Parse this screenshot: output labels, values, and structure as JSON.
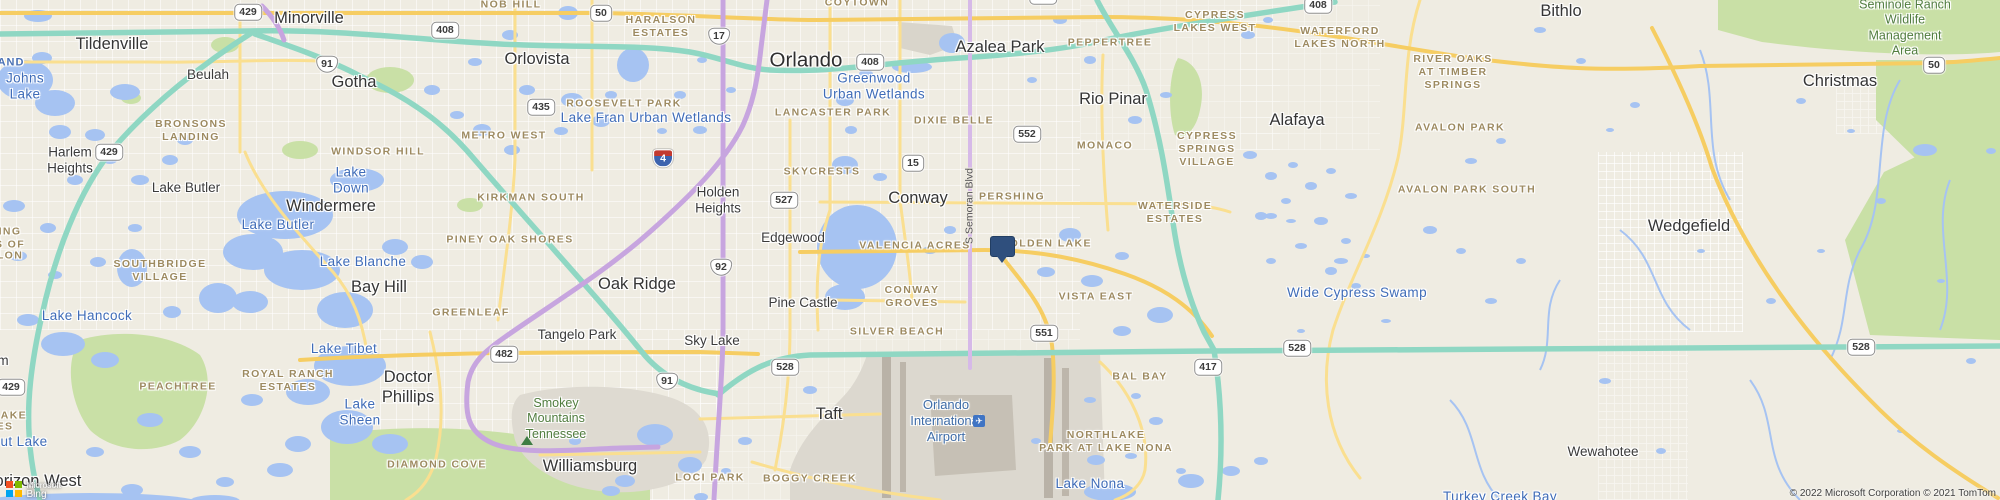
{
  "map": {
    "colors": {
      "land": "#efece2",
      "urban": "#e8e5dc",
      "water": "#a6c3f2",
      "park_green": "#c9e0a6",
      "toll_teal": "#8fd7c3",
      "interstate_purple": "#c7a5df",
      "arterial_yellow": "#f6cd62",
      "marker_navy": "#2f4f7d",
      "water_label_blue": "#3f6cb8",
      "hood_label_brown": "#9d8a60"
    },
    "marker": {
      "x": 1001,
      "y": 247,
      "shape": "pushpin"
    },
    "labels": [
      {
        "t": "Orlando",
        "x": 806,
        "y": 60,
        "c": "city-xl",
        "n": "label-city-orlando"
      },
      {
        "t": "Tildenville",
        "x": 112,
        "y": 44,
        "c": "city-lg",
        "n": "label-city-tildenville"
      },
      {
        "t": "Minorville",
        "x": 309,
        "y": 18,
        "c": "city-lg",
        "n": "label-city-minorville"
      },
      {
        "t": "Beulah",
        "x": 208,
        "y": 75,
        "c": "city",
        "n": "label-city-beulah"
      },
      {
        "t": "Gotha",
        "x": 354,
        "y": 82,
        "c": "city-lg",
        "n": "label-city-gotha"
      },
      {
        "t": "Orlovista",
        "x": 537,
        "y": 59,
        "c": "city-lg",
        "n": "label-city-orlovista"
      },
      {
        "t": "Azalea Park",
        "x": 1000,
        "y": 47,
        "c": "city-lg",
        "n": "label-city-azalea-park"
      },
      {
        "t": "Bithlo",
        "x": 1561,
        "y": 11,
        "c": "city-lg",
        "n": "label-city-bithlo"
      },
      {
        "t": "Christmas",
        "x": 1840,
        "y": 81,
        "c": "city-lg",
        "n": "label-city-christmas"
      },
      {
        "t": "Harlem\nHeights",
        "x": 70,
        "y": 161,
        "c": "city",
        "n": "label-city-harlem-heights"
      },
      {
        "t": "Lake Butler",
        "x": 186,
        "y": 188,
        "c": "city",
        "n": "label-city-lake-butler"
      },
      {
        "t": "Windermere",
        "x": 331,
        "y": 206,
        "c": "city-lg",
        "n": "label-city-windermere"
      },
      {
        "t": "Bay Hill",
        "x": 379,
        "y": 287,
        "c": "city-lg",
        "n": "label-city-bay-hill"
      },
      {
        "t": "Doctor\nPhillips",
        "x": 408,
        "y": 387,
        "c": "city-lg",
        "n": "label-city-doctor-phillips"
      },
      {
        "t": "Oak Ridge",
        "x": 637,
        "y": 284,
        "c": "city-lg",
        "n": "label-city-oak-ridge"
      },
      {
        "t": "Holden\nHeights",
        "x": 718,
        "y": 201,
        "c": "city",
        "n": "label-city-holden-heights"
      },
      {
        "t": "Edgewood",
        "x": 793,
        "y": 238,
        "c": "city",
        "n": "label-city-edgewood"
      },
      {
        "t": "Conway",
        "x": 918,
        "y": 198,
        "c": "city-lg",
        "n": "label-city-conway"
      },
      {
        "t": "Pine Castle",
        "x": 803,
        "y": 303,
        "c": "city",
        "n": "label-city-pine-castle"
      },
      {
        "t": "Rio Pinar",
        "x": 1113,
        "y": 99,
        "c": "city-lg",
        "n": "label-city-rio-pinar"
      },
      {
        "t": "Alafaya",
        "x": 1297,
        "y": 120,
        "c": "city-lg",
        "n": "label-city-alafaya"
      },
      {
        "t": "Wedgefield",
        "x": 1689,
        "y": 226,
        "c": "city-lg",
        "n": "label-city-wedgefield"
      },
      {
        "t": "Taft",
        "x": 829,
        "y": 414,
        "c": "city-lg",
        "n": "label-city-taft"
      },
      {
        "t": "Williamsburg",
        "x": 590,
        "y": 466,
        "c": "city-lg",
        "n": "label-city-williamsburg"
      },
      {
        "t": "Sky Lake",
        "x": 712,
        "y": 341,
        "c": "city",
        "n": "label-city-sky-lake"
      },
      {
        "t": "Tangelo Park",
        "x": 577,
        "y": 335,
        "c": "city",
        "n": "label-city-tangelo-park"
      },
      {
        "t": "Horizon West",
        "x": 32,
        "y": 481,
        "c": "city-lg",
        "n": "label-city-horizon-west"
      },
      {
        "t": "Wewahotee",
        "x": 1603,
        "y": 452,
        "c": "city",
        "n": "label-city-wewahotee"
      },
      {
        "t": "m",
        "x": 3,
        "y": 361,
        "c": "city",
        "n": "label-fragment"
      },
      {
        "t": "Johns\nLake",
        "x": 25,
        "y": 87,
        "c": "water",
        "n": "label-water-johns-lake"
      },
      {
        "t": "Lake\nDown",
        "x": 351,
        "y": 181,
        "c": "water",
        "n": "label-water-lake-down"
      },
      {
        "t": "Lake Butler",
        "x": 278,
        "y": 225,
        "c": "water",
        "n": "label-water-lake-butler"
      },
      {
        "t": "Lake Blanche",
        "x": 363,
        "y": 262,
        "c": "water",
        "n": "label-water-lake-blanche"
      },
      {
        "t": "Lake Tibet",
        "x": 344,
        "y": 349,
        "c": "water",
        "n": "label-water-lake-tibet"
      },
      {
        "t": "Lake\nSheen",
        "x": 360,
        "y": 413,
        "c": "water",
        "n": "label-water-lake-sheen"
      },
      {
        "t": "Lake Hancock",
        "x": 87,
        "y": 316,
        "c": "water",
        "n": "label-water-lake-hancock"
      },
      {
        "t": "ut Lake",
        "x": 24,
        "y": 442,
        "c": "water",
        "n": "label-water-fragment"
      },
      {
        "t": "AND",
        "x": 11,
        "y": 63,
        "c": "water-frag",
        "n": "label-water-fragment"
      },
      {
        "t": "Lake Fran Urban Wetlands",
        "x": 646,
        "y": 118,
        "c": "water",
        "n": "label-water-lake-fran"
      },
      {
        "t": "Greenwood\nUrban Wetlands",
        "x": 874,
        "y": 87,
        "c": "water",
        "n": "label-water-greenwood"
      },
      {
        "t": "Wide Cypress Swamp",
        "x": 1357,
        "y": 293,
        "c": "water",
        "n": "label-water-wide-cypress-swamp"
      },
      {
        "t": "Lake Nona",
        "x": 1090,
        "y": 484,
        "c": "water",
        "n": "label-water-lake-nona"
      },
      {
        "t": "Turkey Creek Bay",
        "x": 1500,
        "y": 497,
        "c": "water",
        "n": "label-water-turkey-creek-bay"
      },
      {
        "t": "NOB HILL",
        "x": 511,
        "y": 5,
        "c": "hood",
        "n": "label-hood-nob-hill"
      },
      {
        "t": "COYTOWN",
        "x": 857,
        "y": 3,
        "c": "hood",
        "n": "label-hood-coytown"
      },
      {
        "t": "HARALSON\nESTATES",
        "x": 661,
        "y": 27,
        "c": "hood",
        "n": "label-hood-haralson-estates"
      },
      {
        "t": "CYPRESS\nLAKES WEST",
        "x": 1215,
        "y": 22,
        "c": "hood",
        "n": "label-hood-cypress-lakes-west"
      },
      {
        "t": "WATERFORD\nLAKES NORTH",
        "x": 1340,
        "y": 38,
        "c": "hood",
        "n": "label-hood-waterford-lakes-north"
      },
      {
        "t": "RIVER OAKS\nAT TIMBER\nSPRINGS",
        "x": 1453,
        "y": 72,
        "c": "hood",
        "n": "label-hood-river-oaks"
      },
      {
        "t": "AVALON PARK",
        "x": 1460,
        "y": 128,
        "c": "hood",
        "n": "label-hood-avalon-park"
      },
      {
        "t": "AVALON PARK SOUTH",
        "x": 1467,
        "y": 190,
        "c": "hood",
        "n": "label-hood-avalon-park-south"
      },
      {
        "t": "PEPPERTREE",
        "x": 1110,
        "y": 43,
        "c": "hood",
        "n": "label-hood-peppertree"
      },
      {
        "t": "ROOSEVELT PARK",
        "x": 624,
        "y": 104,
        "c": "hood",
        "n": "label-hood-roosevelt-park"
      },
      {
        "t": "LANCASTER PARK",
        "x": 833,
        "y": 113,
        "c": "hood",
        "n": "label-hood-lancaster-park"
      },
      {
        "t": "METRO WEST",
        "x": 504,
        "y": 136,
        "c": "hood",
        "n": "label-hood-metro-west"
      },
      {
        "t": "BRONSONS\nLANDING",
        "x": 191,
        "y": 131,
        "c": "hood",
        "n": "label-hood-bronsons-landing"
      },
      {
        "t": "WINDSOR HILL",
        "x": 378,
        "y": 152,
        "c": "hood",
        "n": "label-hood-windsor-hill"
      },
      {
        "t": "KIRKMAN SOUTH",
        "x": 531,
        "y": 198,
        "c": "hood",
        "n": "label-hood-kirkman-south"
      },
      {
        "t": "PINEY OAK SHORES",
        "x": 510,
        "y": 240,
        "c": "hood",
        "n": "label-hood-piney-oak-shores"
      },
      {
        "t": "GREENLEAF",
        "x": 471,
        "y": 313,
        "c": "hood",
        "n": "label-hood-greenleaf"
      },
      {
        "t": "SOUTHBRIDGE\nVILLAGE",
        "x": 160,
        "y": 271,
        "c": "hood",
        "n": "label-hood-southbridge-village"
      },
      {
        "t": "DIXIE BELLE",
        "x": 954,
        "y": 121,
        "c": "hood",
        "n": "label-hood-dixie-belle"
      },
      {
        "t": "SKYCRESTS",
        "x": 822,
        "y": 172,
        "c": "hood",
        "n": "label-hood-skycrests"
      },
      {
        "t": "PERSHING",
        "x": 1012,
        "y": 197,
        "c": "hood",
        "n": "label-hood-pershing"
      },
      {
        "t": "VALENCIA ACRES",
        "x": 915,
        "y": 246,
        "c": "hood",
        "n": "label-hood-valencia-acres"
      },
      {
        "t": "GOLDEN LAKE",
        "x": 1046,
        "y": 244,
        "c": "hood",
        "n": "label-hood-golden-lake"
      },
      {
        "t": "CONWAY\nGROVES",
        "x": 912,
        "y": 297,
        "c": "hood",
        "n": "label-hood-conway-groves"
      },
      {
        "t": "SILVER BEACH",
        "x": 897,
        "y": 332,
        "c": "hood",
        "n": "label-hood-silver-beach"
      },
      {
        "t": "VISTA EAST",
        "x": 1096,
        "y": 297,
        "c": "hood",
        "n": "label-hood-vista-east"
      },
      {
        "t": "MONACO",
        "x": 1105,
        "y": 146,
        "c": "hood",
        "n": "label-hood-monaco"
      },
      {
        "t": "CYPRESS\nSPRINGS\nVILLAGE",
        "x": 1207,
        "y": 149,
        "c": "hood",
        "n": "label-hood-cypress-springs-village"
      },
      {
        "t": "WATERSIDE\nESTATES",
        "x": 1175,
        "y": 213,
        "c": "hood",
        "n": "label-hood-waterside-estates"
      },
      {
        "t": "ROYAL RANCH\nESTATES",
        "x": 288,
        "y": 381,
        "c": "hood",
        "n": "label-hood-royal-ranch-estates"
      },
      {
        "t": "PEACHTREE",
        "x": 178,
        "y": 387,
        "c": "hood",
        "n": "label-hood-peachtree"
      },
      {
        "t": "DIAMOND COVE",
        "x": 437,
        "y": 465,
        "c": "hood",
        "n": "label-hood-diamond-cove"
      },
      {
        "t": "BOGGY CREEK",
        "x": 810,
        "y": 479,
        "c": "hood",
        "n": "label-hood-boggy-creek"
      },
      {
        "t": "BAL BAY",
        "x": 1140,
        "y": 377,
        "c": "hood",
        "n": "label-hood-bal-bay"
      },
      {
        "t": "NORTHLAKE\nPARK AT LAKE NONA",
        "x": 1106,
        "y": 442,
        "c": "hood",
        "n": "label-hood-northlake-park"
      },
      {
        "t": "LOCI PARK",
        "x": 710,
        "y": 478,
        "c": "hood",
        "n": "label-hood-loci-park"
      },
      {
        "t": "ING",
        "x": 10,
        "y": 232,
        "c": "hood",
        "n": "label-fragment"
      },
      {
        "t": "S OF",
        "x": 10,
        "y": 245,
        "c": "hood",
        "n": "label-fragment"
      },
      {
        "t": "LON",
        "x": 10,
        "y": 256,
        "c": "hood",
        "n": "label-fragment"
      },
      {
        "t": "LAKE",
        "x": 10,
        "y": 416,
        "c": "hood",
        "n": "label-fragment"
      },
      {
        "t": "ES",
        "x": 5,
        "y": 427,
        "c": "hood",
        "n": "label-fragment"
      },
      {
        "t": "Seminole Ranch\nWildlife Management\nArea",
        "x": 1905,
        "y": 28,
        "c": "green",
        "n": "label-green-seminole-ranch"
      },
      {
        "t": "Smokey\nMountains\nTennessee",
        "x": 556,
        "y": 419,
        "c": "green",
        "n": "label-green-smokey-mountains"
      },
      {
        "t": "Orlando\nInternational\nAirport",
        "x": 946,
        "y": 421,
        "c": "airport-lbl",
        "n": "label-airport-orlando-international"
      },
      {
        "t": "S Semoran Blvd",
        "x": 970,
        "y": 206,
        "c": "roadname",
        "n": "label-road-s-semoran-blvd"
      }
    ],
    "shields": [
      {
        "v": "429",
        "x": 248,
        "y": 12,
        "k": "fl"
      },
      {
        "v": "429",
        "x": 109,
        "y": 152,
        "k": "fl"
      },
      {
        "v": "429",
        "x": 11,
        "y": 387,
        "k": "fl"
      },
      {
        "v": "408",
        "x": 445,
        "y": 30,
        "k": "fl"
      },
      {
        "v": "408",
        "x": 870,
        "y": 62,
        "k": "fl"
      },
      {
        "v": "408",
        "x": 1318,
        "y": 5,
        "k": "fl"
      },
      {
        "v": "50",
        "x": 601,
        "y": 13,
        "k": "fl"
      },
      {
        "v": "50",
        "x": 1934,
        "y": 65,
        "k": "fl"
      },
      {
        "v": "91",
        "x": 327,
        "y": 64,
        "k": "us"
      },
      {
        "v": "91",
        "x": 667,
        "y": 381,
        "k": "us"
      },
      {
        "v": "17",
        "x": 719,
        "y": 36,
        "k": "us"
      },
      {
        "v": "435",
        "x": 541,
        "y": 107,
        "k": "fl"
      },
      {
        "v": "527",
        "x": 784,
        "y": 200,
        "k": "fl"
      },
      {
        "v": "92",
        "x": 721,
        "y": 267,
        "k": "us"
      },
      {
        "v": "15",
        "x": 913,
        "y": 163,
        "k": "fl"
      },
      {
        "v": "552",
        "x": 1027,
        "y": 134,
        "k": "fl"
      },
      {
        "v": "551",
        "x": 1044,
        "y": 333,
        "k": "fl"
      },
      {
        "v": "551",
        "x": 1043,
        "y": -4,
        "k": "fl"
      },
      {
        "v": "482",
        "x": 504,
        "y": 354,
        "k": "fl"
      },
      {
        "v": "528",
        "x": 785,
        "y": 367,
        "k": "fl"
      },
      {
        "v": "528",
        "x": 1297,
        "y": 348,
        "k": "fl"
      },
      {
        "v": "528",
        "x": 1861,
        "y": 347,
        "k": "fl"
      },
      {
        "v": "417",
        "x": 1208,
        "y": 367,
        "k": "fl"
      },
      {
        "v": "4",
        "x": 663,
        "y": 158,
        "k": "i"
      }
    ],
    "airport_icon_glyph": "✈",
    "logo": {
      "line1": "Microsoft",
      "line2": "Bing"
    },
    "attribution": "© 2022 Microsoft Corporation © 2021 TomTom"
  }
}
